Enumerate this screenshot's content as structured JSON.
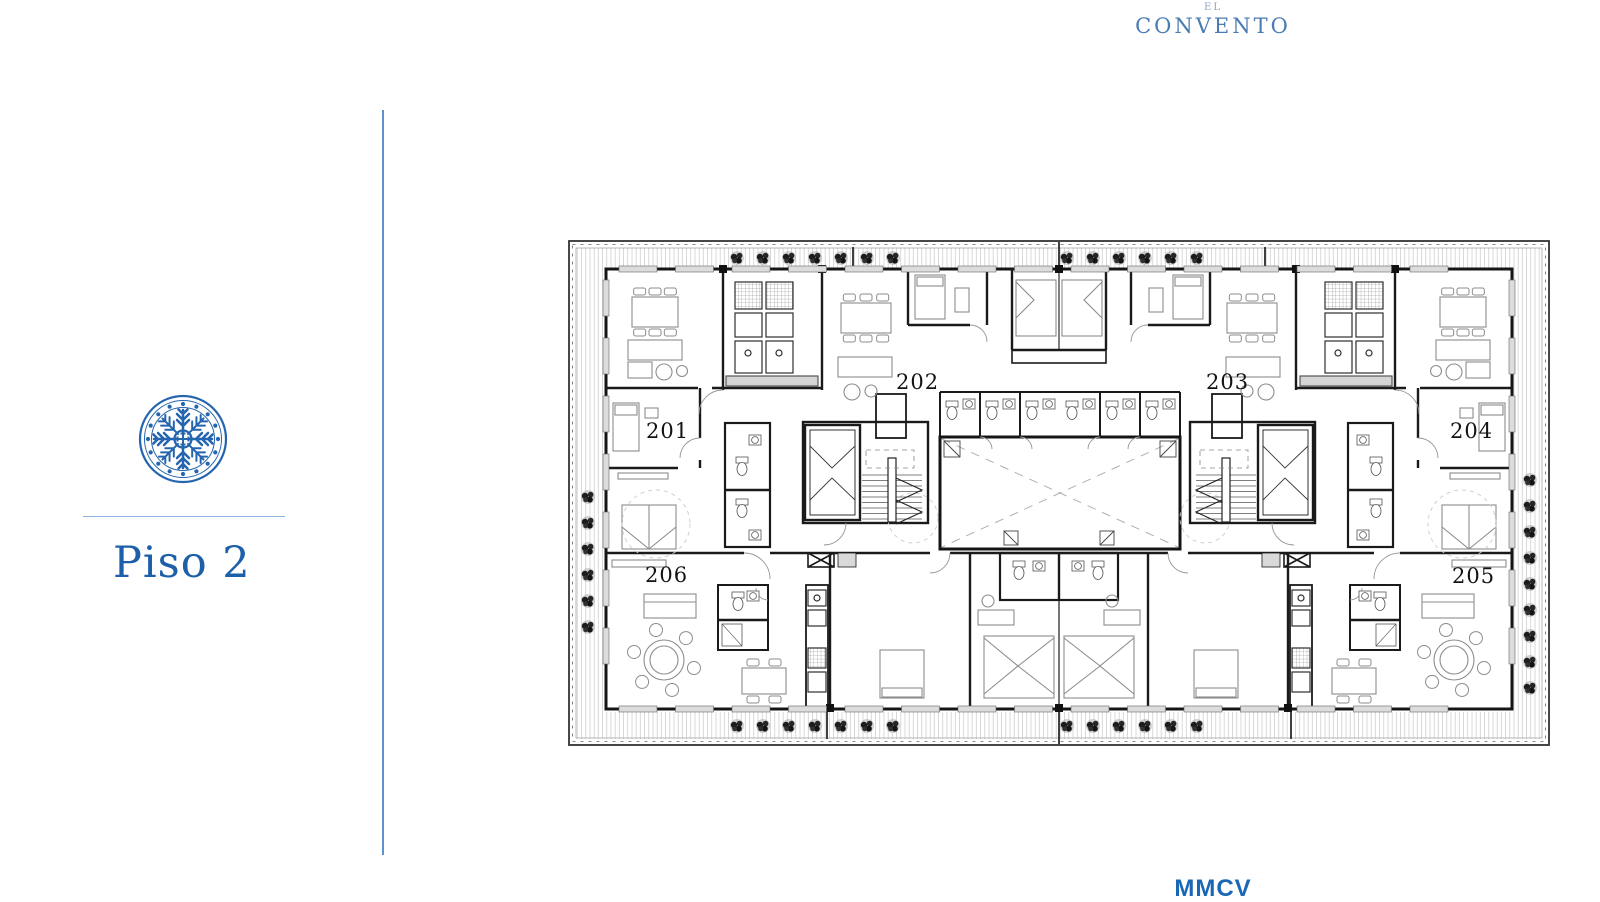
{
  "brand": {
    "prefix": "EL",
    "name": "CONVENTO"
  },
  "floor": {
    "label": "Piso 2"
  },
  "plan": {
    "units": [
      {
        "number": "201"
      },
      {
        "number": "202"
      },
      {
        "number": "203"
      },
      {
        "number": "204"
      },
      {
        "number": "205"
      },
      {
        "number": "206"
      }
    ]
  },
  "footer": {
    "logo_text": "MMCV"
  },
  "colors": {
    "brand_blue": "#4a7cb3",
    "floor_blue": "#1e5fa9",
    "emblem_blue": "#2565ae",
    "rule_blue": "#5e92cc",
    "footer_blue": "#1a67b5",
    "plan_ink": "#1a1a1a",
    "plan_gray": "#8c8c8c"
  }
}
